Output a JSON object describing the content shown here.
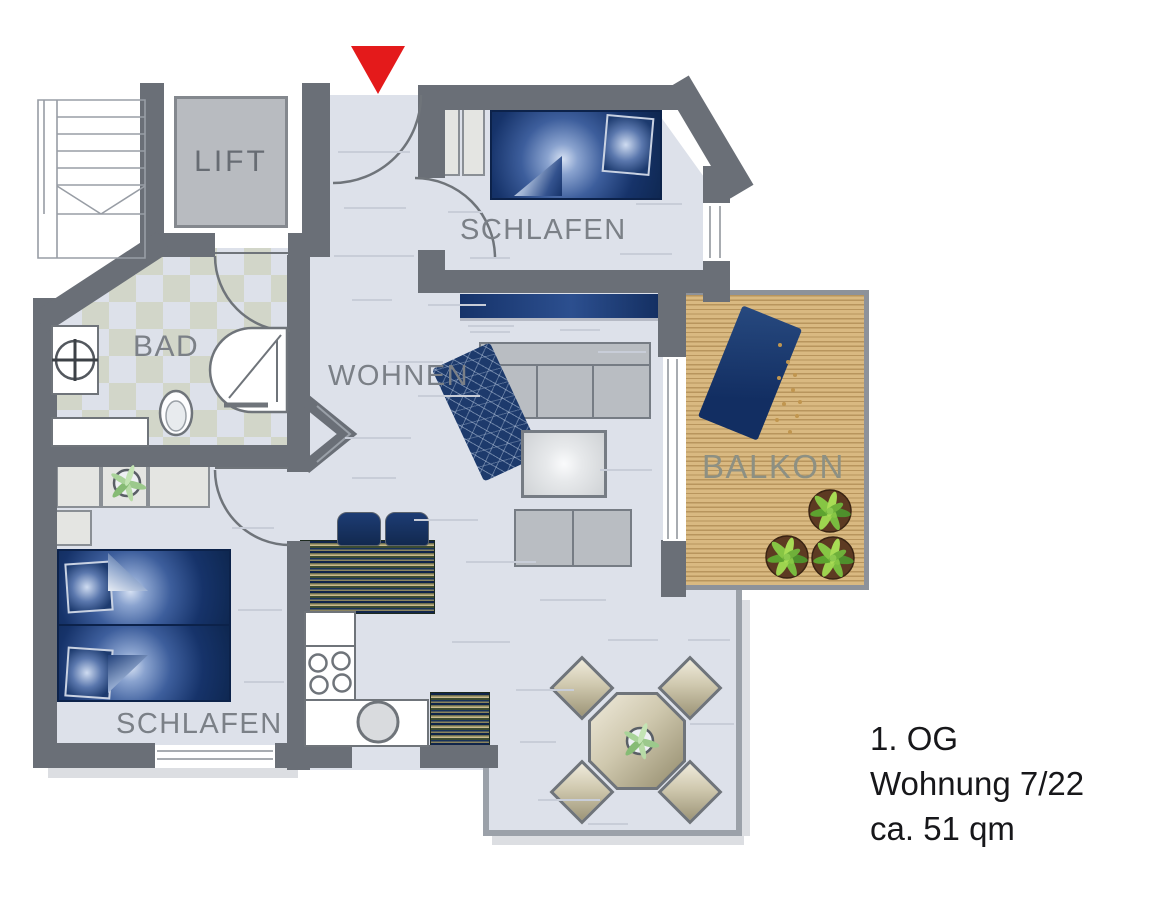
{
  "rooms": {
    "lift": "LIFT",
    "schlafen_top": "SCHLAFEN",
    "bad": "BAD",
    "wohnen": "WOHNEN",
    "balkon": "BALKON",
    "schlafen_bottom": "SCHLAFEN"
  },
  "info": {
    "floor": "1. OG",
    "unit": "Wohnung 7/22",
    "area": "ca. 51 qm"
  },
  "markers": {
    "entrance_arrow": "red-triangle-down-icon"
  },
  "colors": {
    "wall": "#6a6f77",
    "floor": "#dde1ea",
    "bath_tile_alt": "#d2d6c9",
    "furniture_navy": "#16336a",
    "balcony_wood": "#d9b981",
    "entrance_marker_red": "#e41a1b",
    "label_gray": "#7b8087",
    "info_text": "#17171a"
  }
}
